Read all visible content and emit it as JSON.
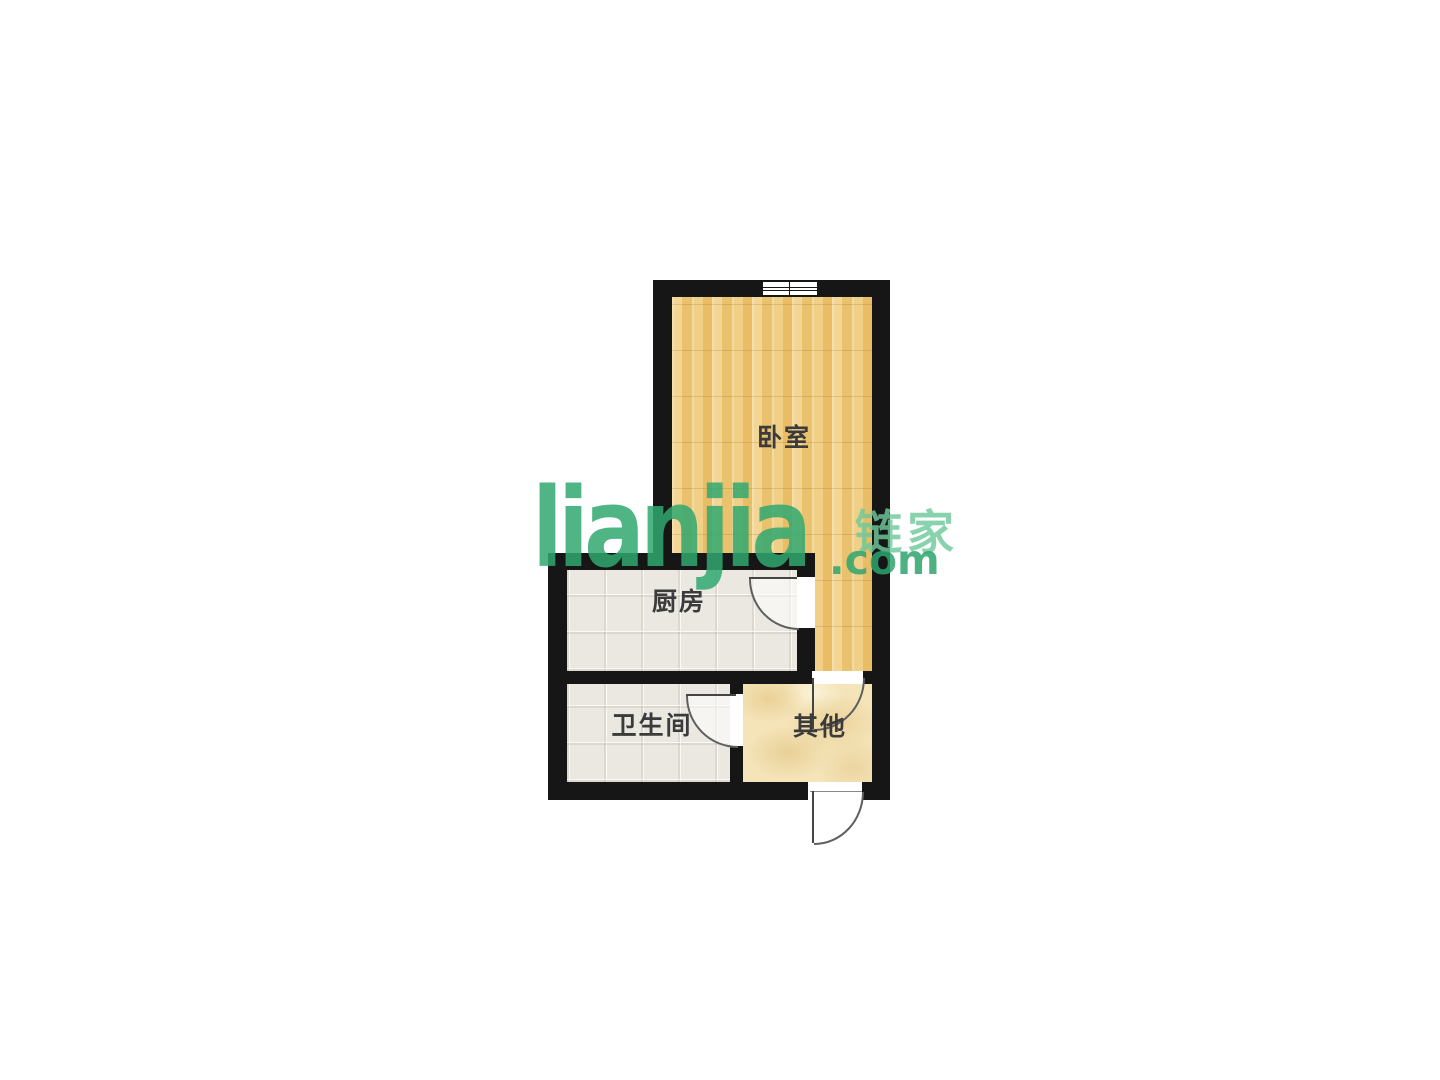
{
  "floorplan": {
    "rooms": {
      "bedroom": {
        "label": "卧室"
      },
      "kitchen": {
        "label": "厨房"
      },
      "bathroom": {
        "label": "卫生间"
      },
      "other": {
        "label": "其他"
      }
    },
    "colors": {
      "wall": "#161616",
      "wood_floor": "#eec87a",
      "tile_floor": "#ebe8e2",
      "marble_floor": "#f4e4b8"
    }
  },
  "watermark": {
    "logo_text": "lianjia",
    "domain_text": ".com",
    "brand_cn": "链家",
    "brand_color": "#2fa86f"
  }
}
